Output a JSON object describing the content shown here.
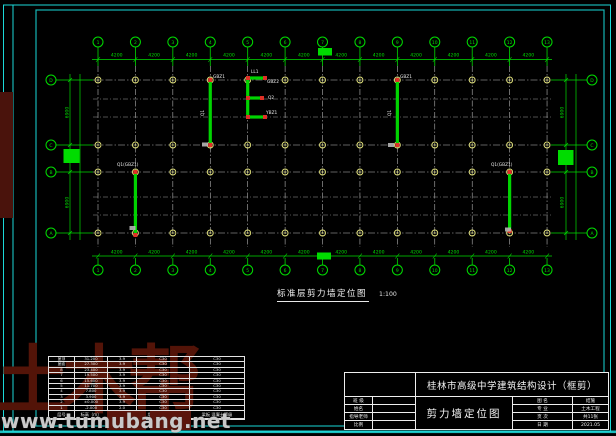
{
  "frame": {
    "border_color": "#1bd9d9"
  },
  "plan": {
    "col_axis_labels": [
      "1",
      "2",
      "3",
      "4",
      "5",
      "6",
      "7",
      "8",
      "9",
      "10",
      "11",
      "12",
      "13"
    ],
    "row_axis_labels": [
      "D",
      "C",
      "B",
      "A"
    ],
    "bay_dim_label": "4200",
    "left_dim_labels": [
      "6900",
      "3000",
      "6900"
    ],
    "right_dim_labels": [
      "6900",
      "3000",
      "6900"
    ],
    "wall_labels": [
      {
        "text": "GBZ1",
        "x": 213,
        "y": 78
      },
      {
        "text": "Q1",
        "x": 204,
        "y": 116,
        "rot": -90
      },
      {
        "text": "GBZ1",
        "x": 400,
        "y": 78
      },
      {
        "text": "Q1",
        "x": 391,
        "y": 116,
        "rot": -90
      },
      {
        "text": "LL1",
        "x": 251,
        "y": 73
      },
      {
        "text": "GBZ2",
        "x": 267,
        "y": 83
      },
      {
        "text": "Q2",
        "x": 268,
        "y": 99
      },
      {
        "text": "YBZ1",
        "x": 266,
        "y": 114
      },
      {
        "text": "Q1(GBZ1)",
        "x": 117,
        "y": 166
      },
      {
        "text": "Q1(GBZ1)",
        "x": 491,
        "y": 166
      }
    ],
    "colors": {
      "axis_green": "#00dc00",
      "grid_white": "#c2c2c2",
      "column_marker_yellow": "#e4e47c",
      "wall_green": "#00d400",
      "wall_end_red": "#e03026",
      "label_white": "#ececec"
    }
  },
  "caption": {
    "title": "标准层剪力墙定位图",
    "scale": "1:100"
  },
  "floor_table": {
    "headers": [
      "层号",
      "标高（m）",
      "层高（m）",
      "墙柱 混凝土等级",
      "梁板 混凝土等级"
    ],
    "rows": [
      [
        "屋顶",
        "31.200",
        "3.9",
        "C30",
        "C30"
      ],
      [
        "屋面",
        "27.300",
        "3.9",
        "C30",
        "C30"
      ],
      [
        "8",
        "23.400",
        "3.9",
        "C30",
        "C30"
      ],
      [
        "7",
        "19.500",
        "3.9",
        "C30",
        "C30"
      ],
      [
        "6",
        "15.600",
        "3.9",
        "C30",
        "C30"
      ],
      [
        "5",
        "11.700",
        "3.9",
        "C30",
        "C30"
      ],
      [
        "4",
        "7.800",
        "3.9",
        "C30",
        "C30"
      ],
      [
        "3",
        "3.900",
        "3.9",
        "C30",
        "C30"
      ],
      [
        "2",
        "±0.000",
        "3.9",
        "C30",
        "C30"
      ],
      [
        "1",
        "-2.000",
        "2.0",
        "C30",
        "C30"
      ]
    ]
  },
  "title_block": {
    "project": "桂林市高级中学建筑结构设计（框剪）",
    "drawing_title": "剪力墙定位图",
    "left_fields": [
      {
        "label": "班 级",
        "value": ""
      },
      {
        "label": "姓名",
        "value": ""
      },
      {
        "label": "指导老师",
        "value": ""
      },
      {
        "label": "比例",
        "value": ""
      }
    ],
    "right_fields": [
      {
        "label": "图 名",
        "value": "结施"
      },
      {
        "label": "专 业",
        "value": "土木工程"
      },
      {
        "label": "页 次",
        "value": "共11张"
      },
      {
        "label": "日 期",
        "value": "2021.05"
      }
    ]
  },
  "watermark": {
    "brand": "土木帮",
    "site": "www.tumubang.net"
  }
}
